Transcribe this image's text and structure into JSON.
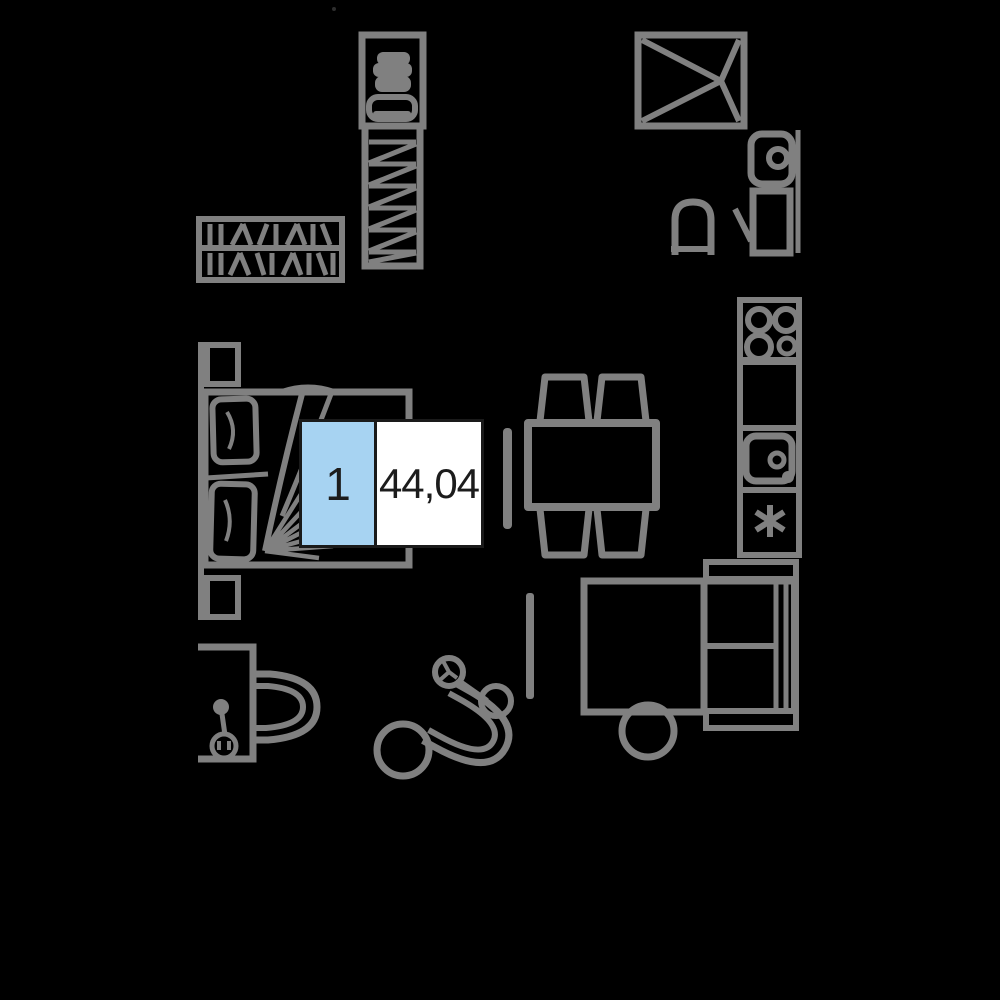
{
  "label": {
    "unit_number": "1",
    "area": "44,04"
  },
  "colors": {
    "background": "#000000",
    "line": "#808080",
    "accent": "#a7d3f2",
    "label_border": "#1a1a1a",
    "label_text": "#1c1c1c",
    "label_white": "#ffffff"
  },
  "floorplan": {
    "items": [
      "hanging-rail-closet",
      "tall-wardrobe",
      "shower-cabin",
      "bathroom-washbasin",
      "bathroom-cabinet",
      "toilet",
      "double-bed",
      "dining-table-with-chairs",
      "tv-panel",
      "kitchen-stove",
      "kitchen-counter",
      "kitchen-sink",
      "freezer-cabinet",
      "corner-sofa-bed",
      "round-coffee-table",
      "desk-with-chair",
      "coat-stand",
      "tub-armchair",
      "round-side-table",
      "floor-lamp",
      "pouf"
    ]
  }
}
